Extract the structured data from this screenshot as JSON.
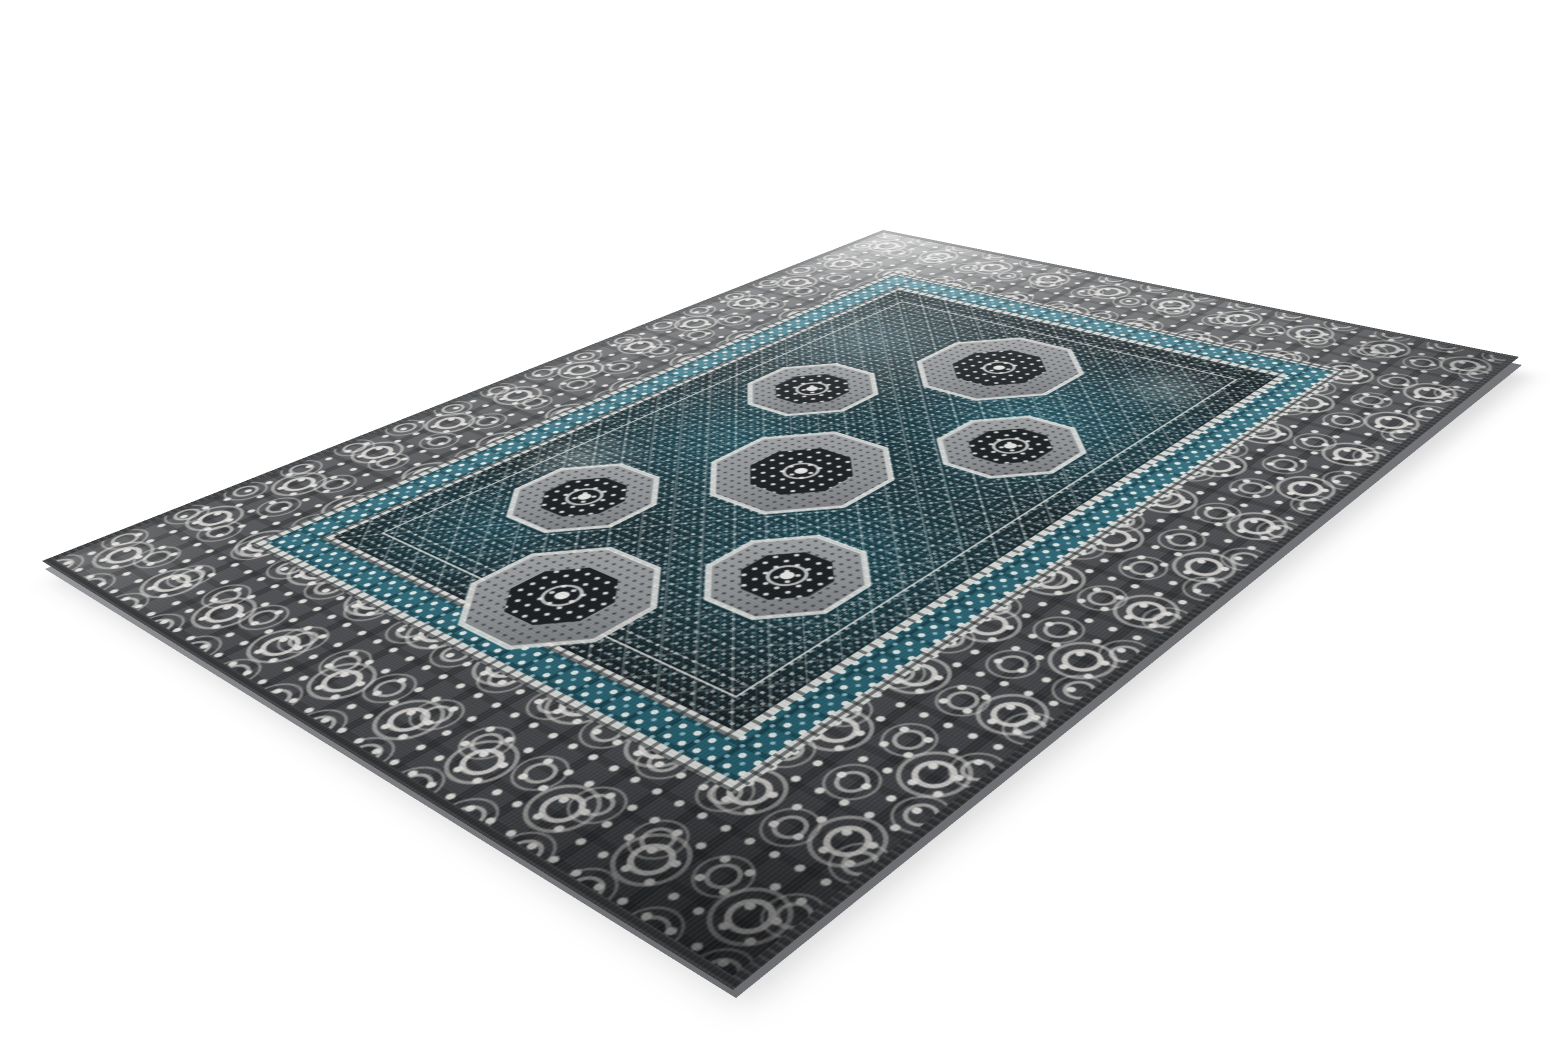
{
  "scene": {
    "type": "studio product photo",
    "subject": "distressed vintage oriental area rug shown at an angle",
    "background": "plain white, no props, faint shadow under near edges"
  },
  "rug": {
    "pattern_style": "Mamluk-inspired all-over geometric pattern with octagonal medallions, dotted lattice field, teal minor border with white rosettes, wide grey border with white damask scroll motifs",
    "finish": "distressed / worn low pile, bound edges (no fringe)"
  },
  "palette": {
    "background": "#ffffff",
    "selvage": "#3a3c3e",
    "border_ground_light": "#6e7073",
    "border_ground_dark": "#3b3d40",
    "ornament_white": "#e7e5e1",
    "guard_white": "#d9dbd8",
    "minor_teal": "#2c6f81",
    "field_base": "#1d2629",
    "field_teal": "#2a6c7e",
    "field_blue_light": "#8fbecb",
    "medallion_grey": "#909396",
    "medallion_dark": "#1b1f22",
    "side_edge": "#85878a"
  }
}
